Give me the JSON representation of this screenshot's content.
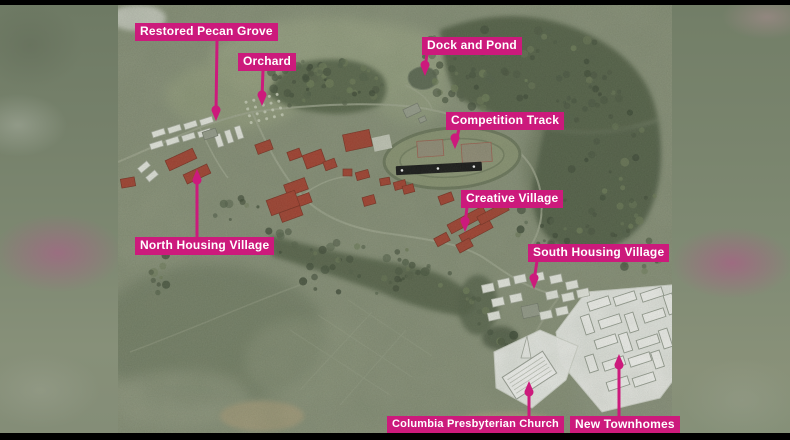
{
  "labels": [
    {
      "id": "restored-pecan-grove",
      "text": "Restored Pecan Grove"
    },
    {
      "id": "orchard",
      "text": "Orchard"
    },
    {
      "id": "dock-and-pond",
      "text": "Dock and Pond"
    },
    {
      "id": "competition-track",
      "text": "Competition Track"
    },
    {
      "id": "creative-village",
      "text": "Creative Village"
    },
    {
      "id": "north-housing-village",
      "text": "North Housing Village"
    },
    {
      "id": "south-housing-village",
      "text": "South Housing Village"
    },
    {
      "id": "columbia-presbyterian-church",
      "text": "Columbia Presbyterian Church"
    },
    {
      "id": "new-townhomes",
      "text": "New Townhomes"
    }
  ],
  "colors": {
    "label_bg": "#cc1a7c",
    "label_text": "#ffffff",
    "leader_line": "#cc1a7c"
  }
}
